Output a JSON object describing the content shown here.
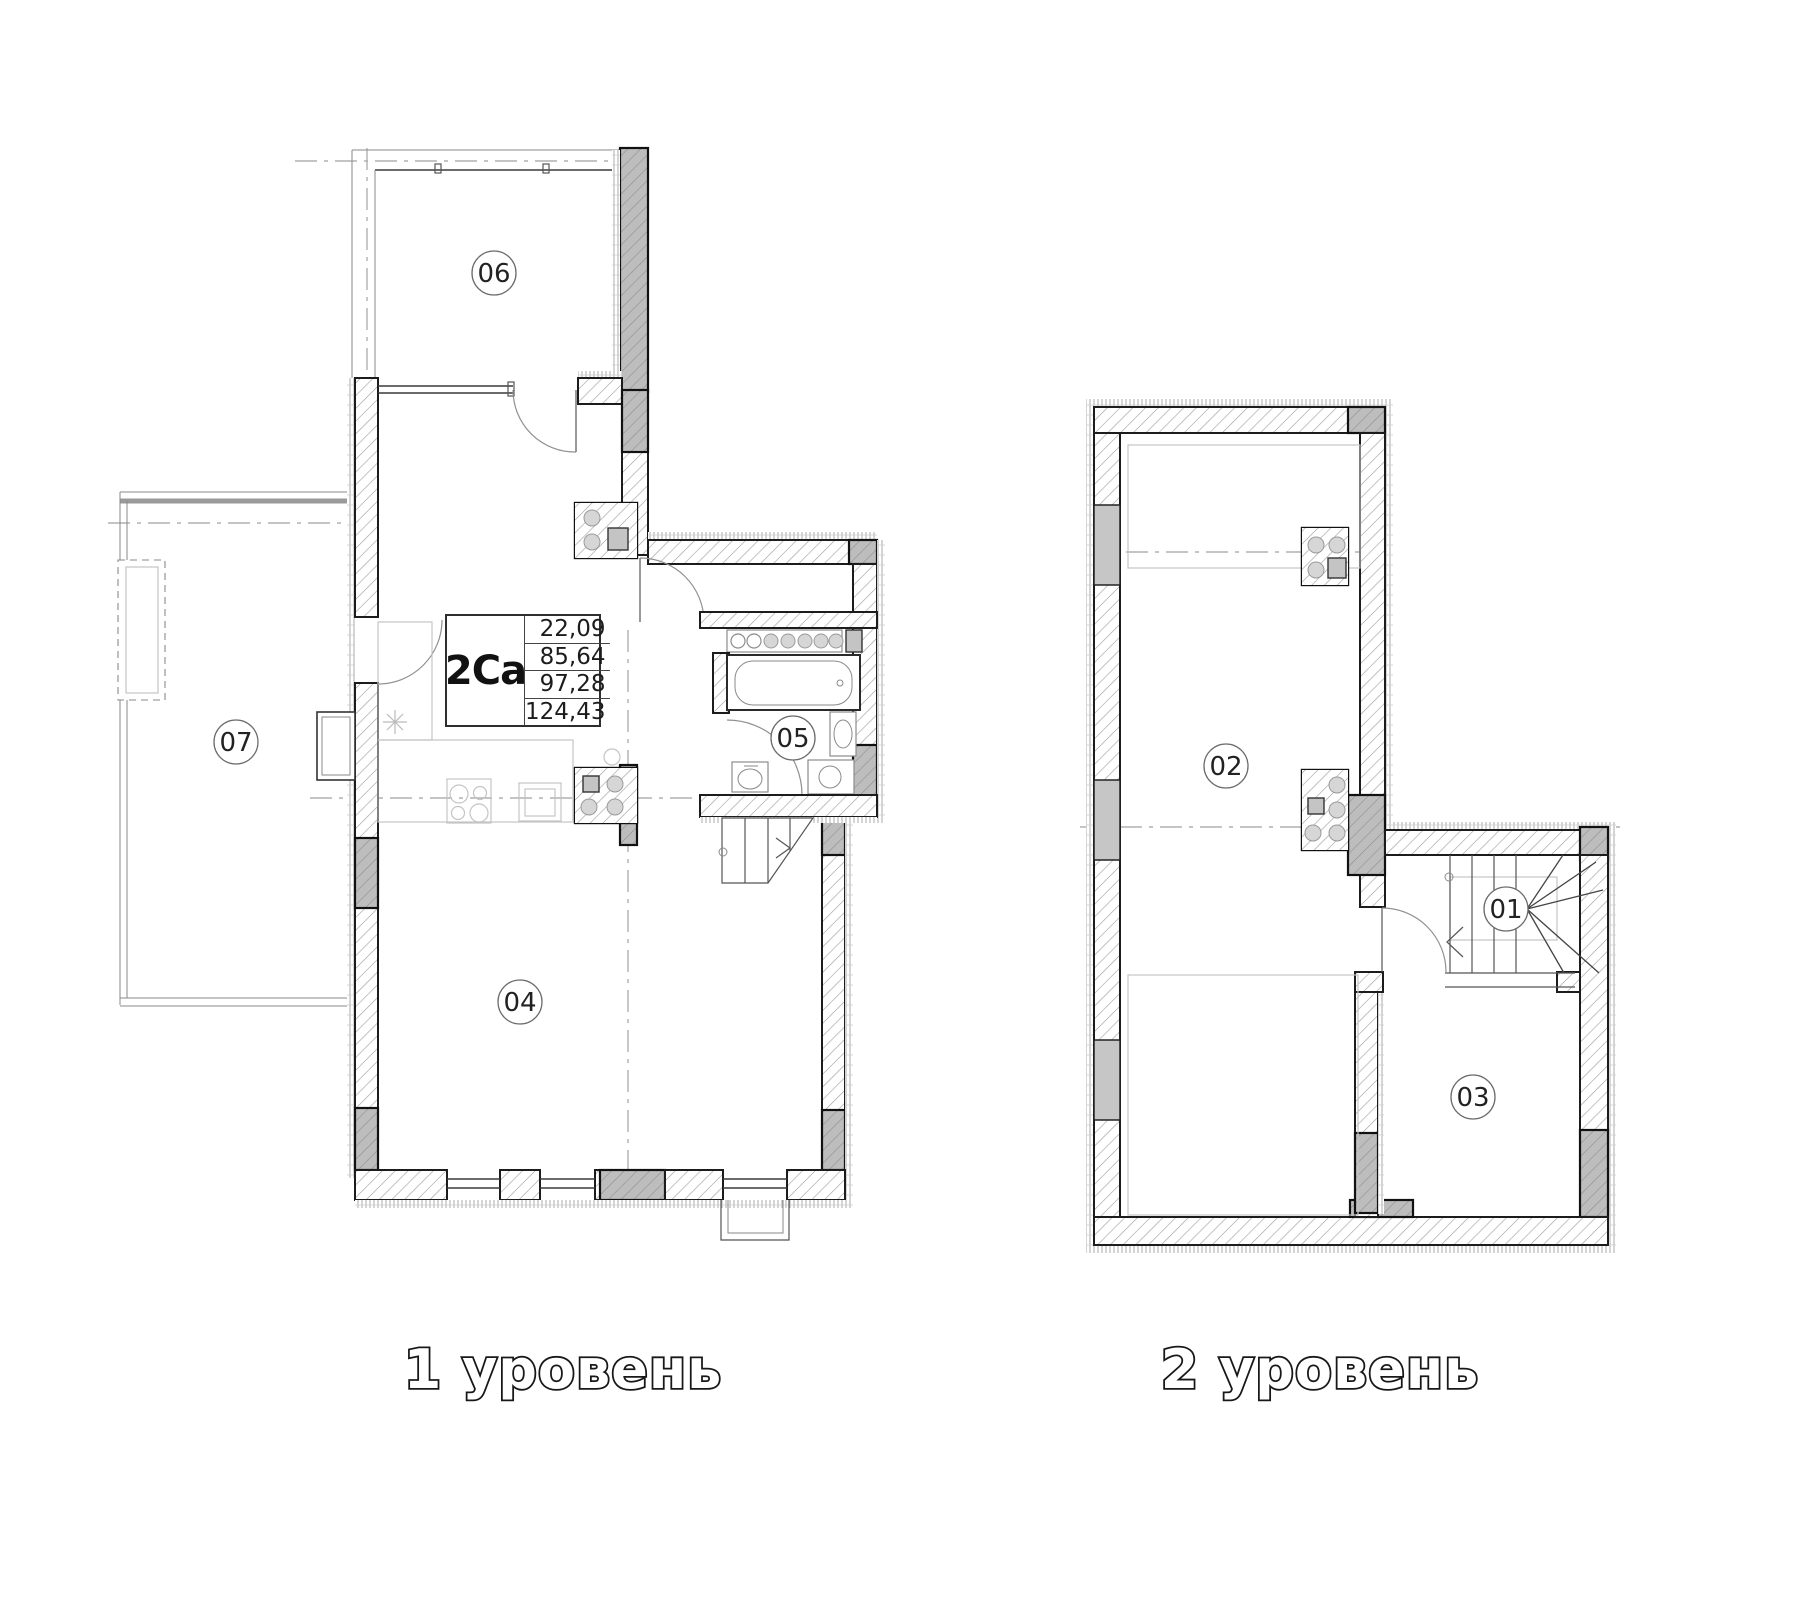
{
  "plan": {
    "type_label": "2Ca",
    "areas": {
      "a1": "22,09",
      "a2": "85,64",
      "a3": "97,28",
      "a4": "124,43"
    },
    "levels": {
      "level1": {
        "caption": "1 уровень",
        "rooms": {
          "r04": "04",
          "r05": "05",
          "r06": "06",
          "r07": "07"
        }
      },
      "level2": {
        "caption": "2 уровень",
        "rooms": {
          "r01": "01",
          "r02": "02",
          "r03": "03"
        }
      }
    }
  },
  "colors": {
    "background": "#ffffff",
    "wall_line": "#1c1c1c",
    "wall_hatch": "#9c9c9c",
    "column_fill": "#bdbdbd",
    "axis_line": "#b0b0b0",
    "fixture_fill": "#d6d6d6",
    "caption_fill": "#ffffff",
    "caption_outline": "#181818"
  }
}
